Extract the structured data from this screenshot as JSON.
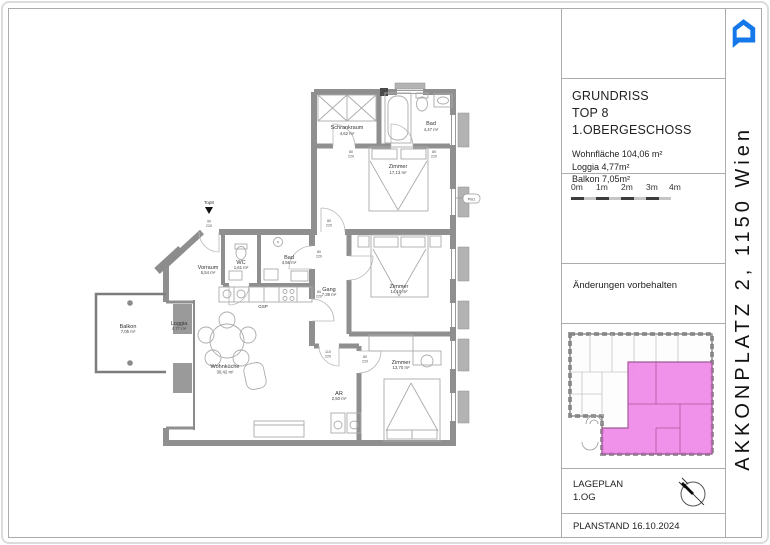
{
  "title_block": {
    "title_lines": [
      "GRUNDRISS",
      "TOP 8",
      "1.OBERGESCHOSS"
    ],
    "areas": [
      "Wohnfläche 104,06 m²",
      "Loggia 4,77m²",
      "Balkon 7,05m²"
    ]
  },
  "scale_bar": {
    "labels": [
      "0m",
      "1m",
      "2m",
      "3m",
      "4m"
    ]
  },
  "disclaimer": "Änderungen vorbehalten",
  "lageplan": {
    "title": "LAGEPLAN",
    "floor": "1.OG"
  },
  "planstand": "PLANSTAND 16.10.2024",
  "address": "AKKONPLATZ 2, 1150 Wien",
  "colors": {
    "accent_blue": "#1478EA",
    "highlight_pink": "#EF7FE6"
  },
  "floor_plan": {
    "entrance_label": "Top8",
    "kitchen_label": "GSP",
    "marker_label": "PB1",
    "rooms": [
      {
        "name": "Schrankraum",
        "area": "4,62 m²"
      },
      {
        "name": "Bad",
        "area": "4,47 m²"
      },
      {
        "name": "Zimmer",
        "area": "17,13 m²"
      },
      {
        "name": "WC",
        "area": "1,61 m²"
      },
      {
        "name": "Bad",
        "area": "4,56 m²"
      },
      {
        "name": "Vorraum",
        "area": "5,54 m²"
      },
      {
        "name": "Gang",
        "area": "7,39 m²"
      },
      {
        "name": "Zimmer",
        "area": "14,10 m²"
      },
      {
        "name": "Zimmer",
        "area": "13,70 m²"
      },
      {
        "name": "AR",
        "area": "2,50 m²"
      },
      {
        "name": "Wohnküche",
        "area": "30,42 m²"
      },
      {
        "name": "Loggia",
        "area": "4,77 m²"
      },
      {
        "name": "Balkon",
        "area": "7,05 m²"
      }
    ],
    "door_dims": [
      {
        "w": "80",
        "h": "220"
      },
      {
        "w": "80",
        "h": "220"
      },
      {
        "w": "80",
        "h": "220"
      },
      {
        "w": "80",
        "h": "220"
      },
      {
        "w": "80",
        "h": "220"
      },
      {
        "w": "110",
        "h": "220"
      },
      {
        "w": "80",
        "h": "220"
      },
      {
        "w": "90",
        "h": "220"
      }
    ]
  }
}
